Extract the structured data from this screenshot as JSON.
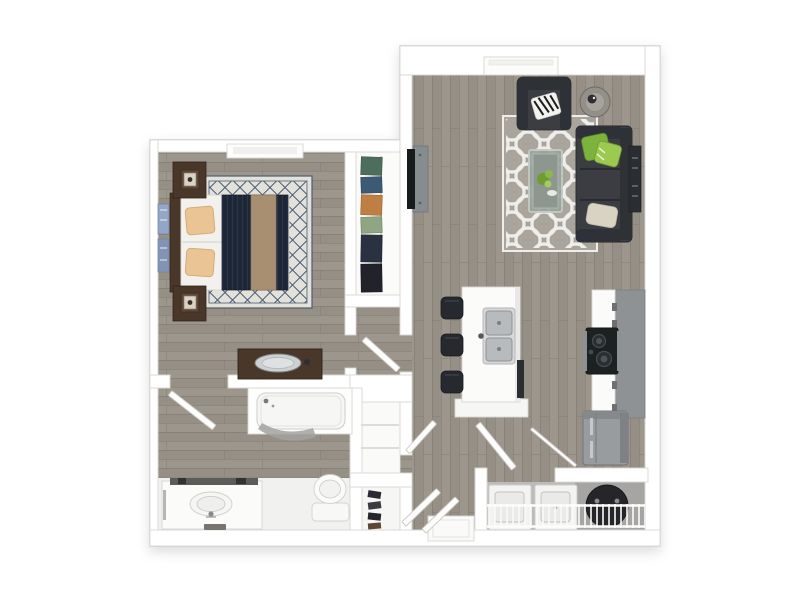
{
  "colors": {
    "canvas": "#ffffff",
    "wall": "#ffffff",
    "wall_outline": "#c6c4c1",
    "wall_edge": "#d9d7d4",
    "floor_wood": "#968f85",
    "floor_plank_light": "#9d968c",
    "floor_plank_line": "#837c72",
    "bath_tile": "#f1f1ef",
    "closet_floor": "#fbfbf9",
    "laundry_floor": "#bcbbb9",
    "concrete": "#a6a5a3",
    "sofa": "#3b3e43",
    "sofa_dark": "#2e3136",
    "pillow_green": "#7db33e",
    "pillow_green_light": "#9cc94f",
    "pillow_cream": "#d8d3c2",
    "rug_living": "#a9a59d",
    "rug_pattern_white": "#efeeea",
    "rug_bedroom": "#e3e2da",
    "rug_lattice_navy": "#4c5c76",
    "bedding_white": "#f2f1ee",
    "bedding_navy": "#1d2535",
    "bedding_tan": "#a98f72",
    "pillow_tan": "#eac494",
    "wood_dark": "#4a382b",
    "art_blue": "#93a6c6",
    "counter_white": "#fbfbfa",
    "cabinet_gray": "#8f9294",
    "stainless": "#989c9f",
    "appliance_black": "#1e2023",
    "fixture_white": "#fbfbfa",
    "glass_table": "#9aa39d",
    "plant_green": "#6f9c33",
    "door_leaf": "#fdfdfc",
    "clothes_teal": "#4e6e5c",
    "clothes_blue": "#3d5a74",
    "clothes_orange": "#c07f42",
    "clothes_sage": "#8fa583",
    "clothes_navy": "#2b3343",
    "clothes_black": "#22242b"
  },
  "floorplan": {
    "type": "3d-top-down-floor-plan",
    "unit": "one-bedroom-one-bathroom-apartment",
    "rooms": [
      {
        "name": "living-room",
        "furniture": [
          "sofa",
          "armchair",
          "zebra-pillow",
          "green-pillows",
          "cream-pillow",
          "trellis-area-rug",
          "glass-coffee-table",
          "round-side-table",
          "wall-tv",
          "entry-console",
          "wall-panel"
        ]
      },
      {
        "name": "kitchen",
        "furniture": [
          "island-with-double-sink",
          "bar-stool",
          "bar-stool",
          "bar-stool",
          "range",
          "counter",
          "cabinets",
          "refrigerator"
        ]
      },
      {
        "name": "bedroom",
        "furniture": [
          "bed",
          "nightstand",
          "nightstand",
          "table-lamp",
          "table-lamp",
          "lattice-area-rug",
          "dresser-with-mirror",
          "wall-art",
          "window"
        ]
      },
      {
        "name": "bedroom-closet",
        "furniture": [
          "closet-rod",
          "hanging-clothes"
        ]
      },
      {
        "name": "bathroom",
        "furniture": [
          "bathtub",
          "bath-mat",
          "vanity-sink",
          "towel-bar",
          "toilet"
        ]
      },
      {
        "name": "linen-closet",
        "furniture": [
          "shelves"
        ]
      },
      {
        "name": "shoe-closet",
        "furniture": [
          "shoes"
        ]
      },
      {
        "name": "laundry-closet",
        "furniture": [
          "washer",
          "dryer",
          "water-heater",
          "wire-shelf"
        ]
      },
      {
        "name": "entry",
        "furniture": [
          "door-mat"
        ]
      }
    ],
    "doors": [
      "bathroom-door",
      "bedroom-door",
      "hall-closet-door",
      "entry-door-left",
      "entry-door-right",
      "laundry-door",
      "laundry-door-rail"
    ]
  }
}
